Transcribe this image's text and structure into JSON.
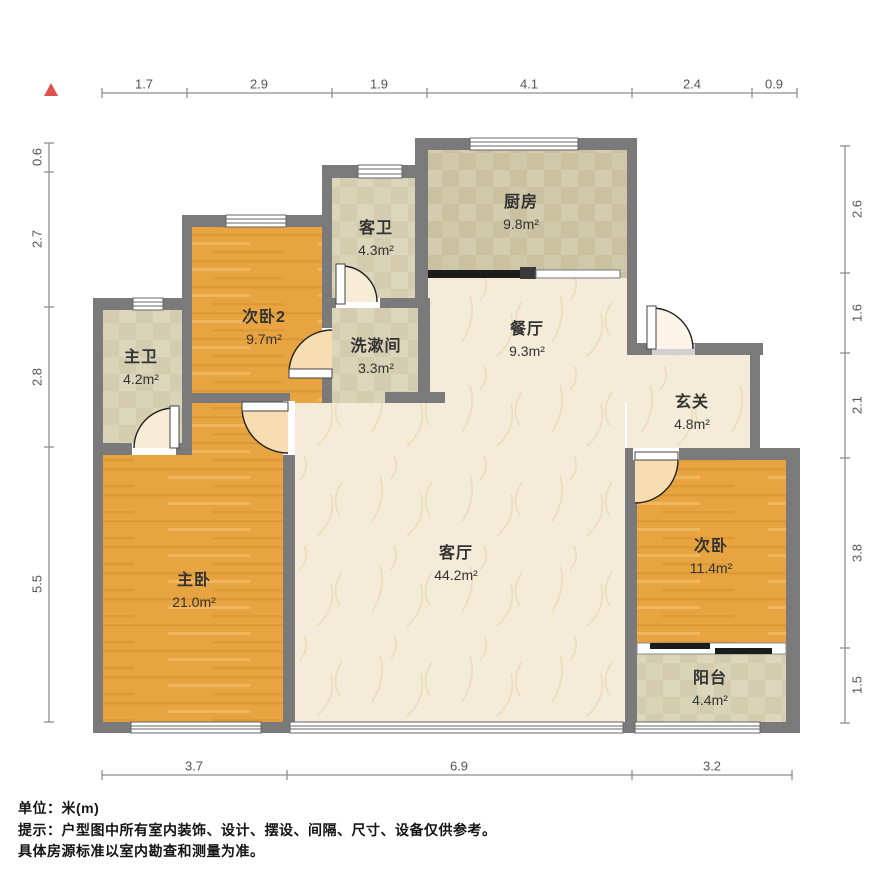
{
  "title": "户型图",
  "rooms": [
    {
      "name": "次卧2",
      "area": "9.7m²"
    },
    {
      "name": "客卫",
      "area": "4.3m²"
    },
    {
      "name": "厨房",
      "area": "9.8m²"
    },
    {
      "name": "餐厅",
      "area": "9.3m²"
    },
    {
      "name": "洗漱间",
      "area": "3.3m²"
    },
    {
      "name": "主卫",
      "area": "4.2m²"
    },
    {
      "name": "玄关",
      "area": "4.8m²"
    },
    {
      "name": "主卧",
      "area": "21.0m²"
    },
    {
      "name": "客厅",
      "area": "44.2m²"
    },
    {
      "name": "次卧",
      "area": "11.4m²"
    },
    {
      "name": "阳台",
      "area": "4.4m²"
    }
  ],
  "dimensions": {
    "top": [
      "1.7",
      "2.9",
      "1.9",
      "4.1",
      "2.4",
      "0.9"
    ],
    "left": [
      "0.6",
      "2.7",
      "2.8",
      "5.5"
    ],
    "right": [
      "2.6",
      "1.6",
      "2.1",
      "3.8",
      "1.5"
    ],
    "bottom": [
      "3.7",
      "6.9",
      "3.2"
    ]
  },
  "footer": {
    "unit_line": "单位：米(m)",
    "hint_line1": "提示：户型图中所有室内装饰、设计、摆设、间隔、尺寸、设备仅供参考。",
    "hint_line2": "具体房源标准以室内勘查和测量为准。"
  },
  "colors": {
    "wall": "#7a7a7a",
    "wood_floor": "#e7a440",
    "tile_floor": "#d9d3b8",
    "kitchen_floor": "#cfc8a9",
    "living_floor": "#f4ecd8",
    "north_arrow": "#e0524e",
    "dimension_line": "#8e8e8e"
  }
}
